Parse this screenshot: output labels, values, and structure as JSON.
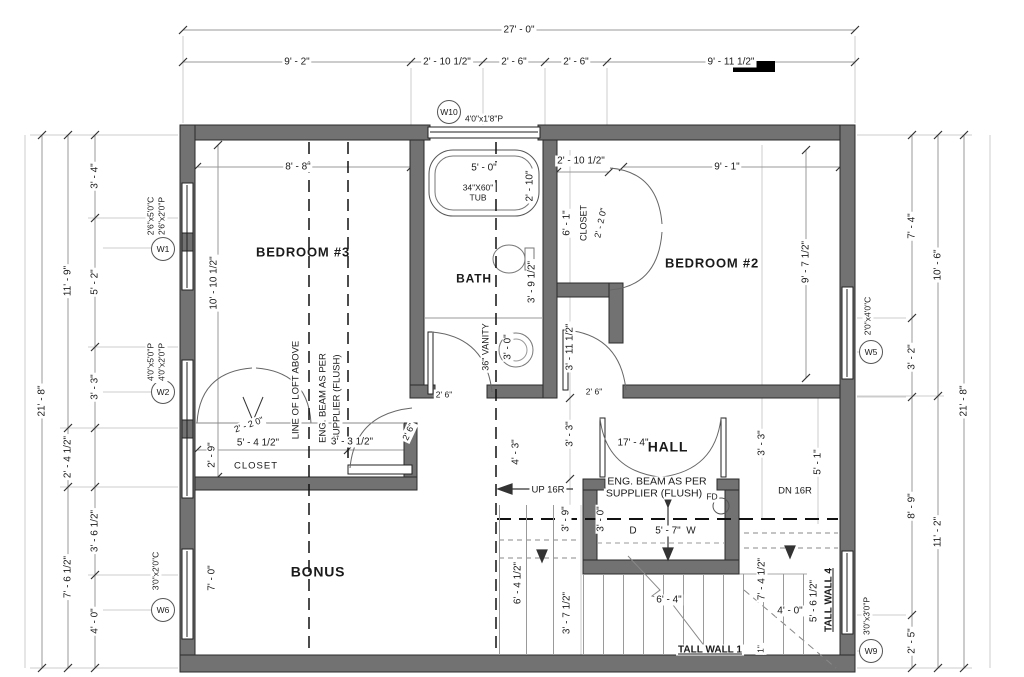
{
  "dims_top": {
    "overall": "27' - 0\"",
    "s1": "9' - 2\"",
    "s2": "2' - 10 1/2\"",
    "s3": "2' - 6\"",
    "s4": "2' - 6\"",
    "s5": "9' - 11 1/2\""
  },
  "dims_left": {
    "total": "21' - 8\"",
    "m1": "11' - 9\"",
    "m2": "2' - 4 1/2\"",
    "m3": "7' - 6 1/2\"",
    "i1": "3' - 4\"",
    "i2": "5' - 2\"",
    "i3": "3' - 3\"",
    "i4": "3' - 6 1/2\"",
    "i5": "4' - 0\""
  },
  "dims_right": {
    "total": "21' - 8\"",
    "m1": "10' - 6\"",
    "m2": "11' - 2\"",
    "i1": "7' - 4\"",
    "i2": "3' - 2\"",
    "i3": "8' - 9\"",
    "i4": "2' - 5\""
  },
  "windows": {
    "w1": {
      "id": "W1",
      "l1": "2'6\"x5'0\"C",
      "l2": "2'6\"x2'0\"P"
    },
    "w2": {
      "id": "W2",
      "l1": "4'0\"x5'0\"P",
      "l2": "4'0\"x2'0\"P"
    },
    "w5": {
      "id": "W5",
      "l1": "2'0\"x4'0\"C"
    },
    "w6": {
      "id": "W6",
      "l1": "3'0\"x2'0\"C"
    },
    "w9": {
      "id": "W9",
      "l1": "3'0\"x3'0\"P"
    },
    "w10": {
      "id": "W10",
      "l1": "4'0\"x1'8\"P"
    }
  },
  "bedroom3": {
    "name": "BEDROOM #3",
    "w": "8' - 8\"",
    "d": "10' - 10 1/2\"",
    "loft": "LINE OF LOFT ABOVE",
    "beam1": "ENG. BEAM AS PER",
    "beam2": "SUPPLIER (FLUSH)"
  },
  "bath": {
    "name": "BATH",
    "tub_w": "5' - 0\"",
    "tub1": "34\"X60\"",
    "tub2": "TUB",
    "tub_d": "2' - 10\"",
    "wc": "3' - 9 1/2\"",
    "vanity": "36\" VANITY",
    "sink": "3' - 0\""
  },
  "bedroom2": {
    "name": "BEDROOM #2",
    "w": "9' - 1\"",
    "d": "9' - 7 1/2\"",
    "cl_w": "2' - 10 1/2\"",
    "cl_d": "6' - 1\"",
    "cl": "CLOSET",
    "cl_door": "2' - 2 0\""
  },
  "closet3": {
    "label": "CLOSET",
    "w": "5' - 4 1/2\"",
    "d": "2' - 9\"",
    "door": "2' - 2 0\"",
    "r": "3' - 3 1/2\""
  },
  "hall": {
    "name": "HALL",
    "w": "17' - 4\"",
    "d1": "4' - 3\"",
    "d2": "3' - 3\"",
    "d3": "3' - 11 1/2\"",
    "d4": "3' - 3\"",
    "d5": "5' - 1\"",
    "d6": "3' - 9\"",
    "up": "UP 16R",
    "dn": "DN 16R"
  },
  "laundry": {
    "beam1": "ENG. BEAM AS PER",
    "beam2": "SUPPLIER (FLUSH)",
    "fd": "FD",
    "d": "D",
    "w": "W",
    "width": "5' - 7\"",
    "depth": "3' - 0\""
  },
  "stairs": {
    "s1": "6' - 4 1/2\"",
    "s2": "3' - 7 1/2\"",
    "s3": "6' - 4\"",
    "s4": "7' - 4 1/2\"",
    "s5": "4' - 0\"",
    "s6": "5' - 6 1/2\"",
    "tw1": "TALL WALL 1",
    "tw4": "TALL WALL 4",
    "one": "1\""
  },
  "bonus": {
    "name": "BONUS",
    "d": "7' - 0\""
  },
  "door_label": "2' 6\"",
  "colors": {
    "wall": "#727272",
    "line": "#999999",
    "marker": "#000000"
  }
}
